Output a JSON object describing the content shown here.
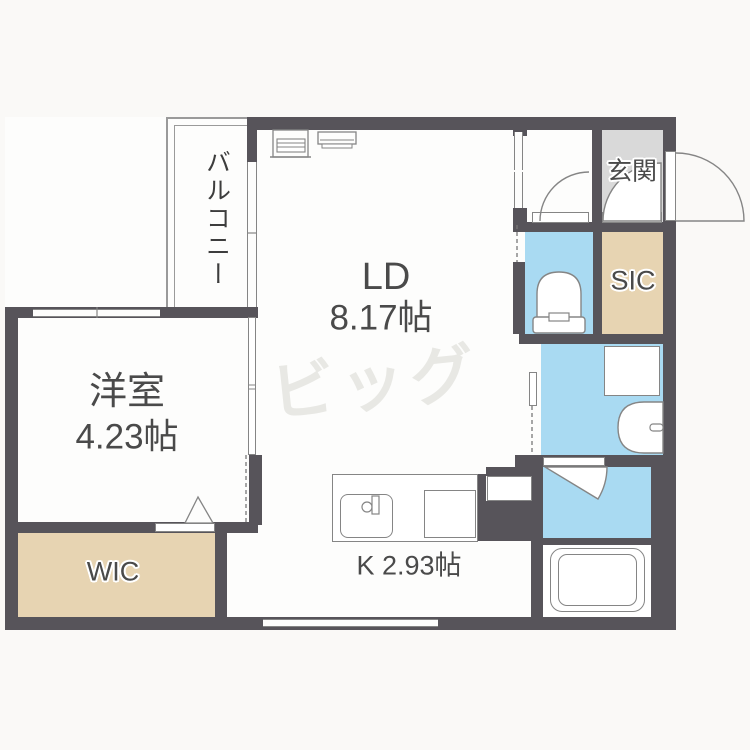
{
  "floorplan": {
    "rooms": {
      "living_dining": {
        "name": "LD",
        "area": "8.17帖"
      },
      "western_room": {
        "name": "洋室",
        "area": "4.23帖"
      },
      "kitchen": {
        "label": "K 2.93帖"
      },
      "wic": {
        "label": "WIC"
      },
      "sic": {
        "label": "SIC"
      },
      "genkan": {
        "label": "玄関"
      },
      "balcony": {
        "label": "バルコニー"
      }
    },
    "watermark": "ビッグ",
    "fixtures": [
      "toilet",
      "washbasin",
      "bathtub",
      "kitchen-sink",
      "washer-pan",
      "air-conditioner"
    ],
    "colors": {
      "wall": "#57545a",
      "wet": "#a9daf2",
      "closet": "#e7d4b2",
      "entry": "#d9d9d9",
      "line": "#858585",
      "floor": "#fdfdfc",
      "bg": "#faf9f7",
      "text": "#4a4a4a",
      "watermark": "#e8e8e4",
      "rail": "#9a9a9a"
    }
  }
}
